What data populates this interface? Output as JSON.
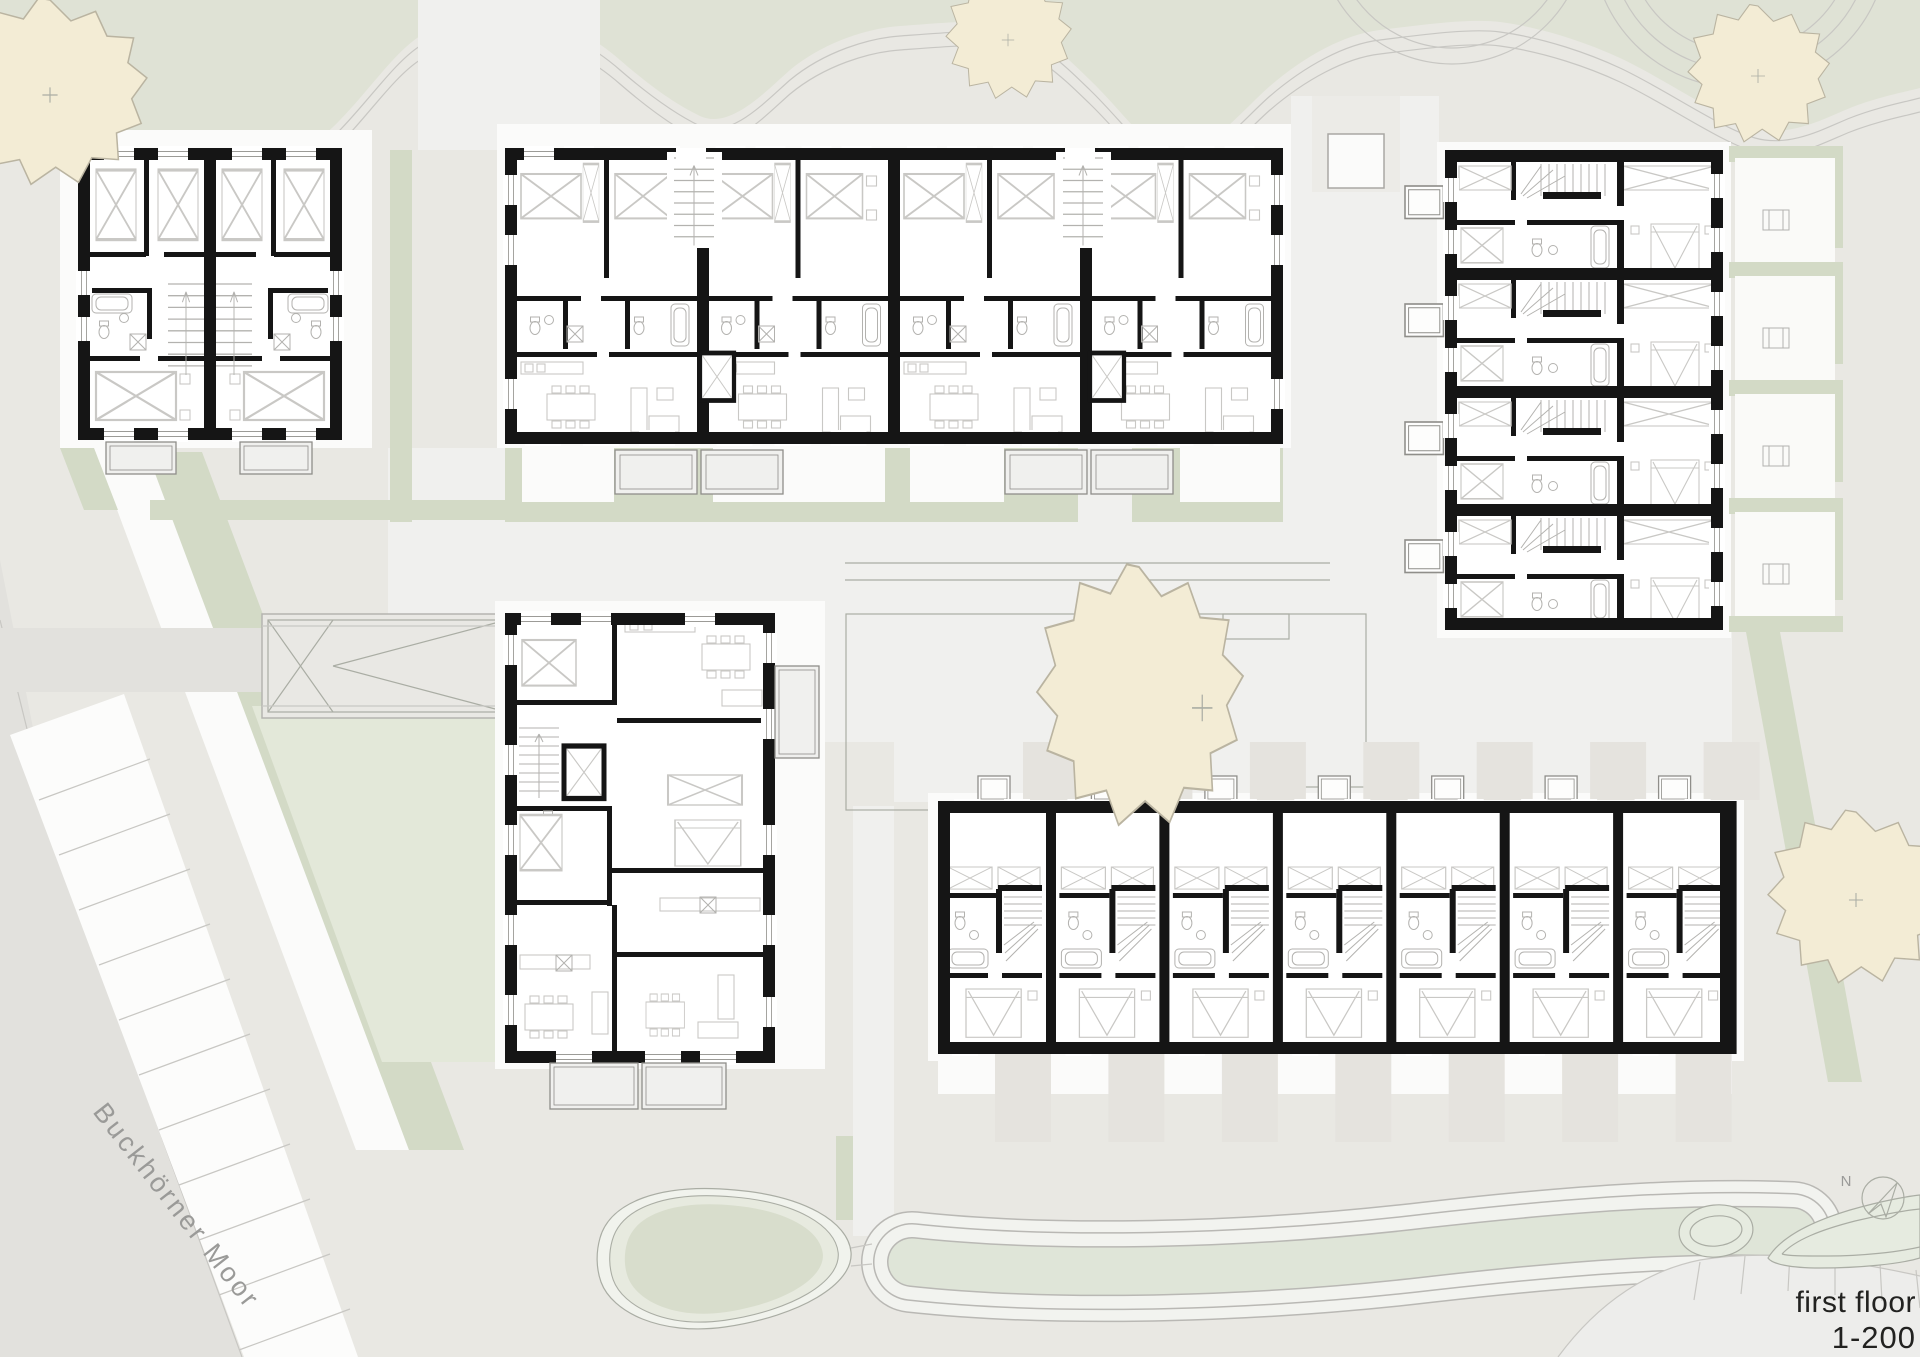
{
  "labels": {
    "floor": "first floor",
    "scale": "1-200",
    "street": "Buckhörner Moor",
    "north": "N"
  },
  "colors": {
    "base": "#e9e8e3",
    "band": "#dfe2d5",
    "hedge": "#d3dac6",
    "garden": "#e3e8d9",
    "plaza": "#f0f0ee",
    "pad": "#fbfbfa",
    "street": "#e2e1dd",
    "parking": "#fcfcfb",
    "graypad": "#e5e3de",
    "wall": "#151515",
    "furniture": "#c9c8c5",
    "fixture": "#b3b2af",
    "outline": "#aaada4",
    "edge": "#c8c7c3",
    "sill": "#9c9b97",
    "tree": "#f3ecd5",
    "treeline": "#bab4a1",
    "pondouter": "#f1f3ed",
    "pondmid": "#e7eadf",
    "pondcore": "#d8ddcc",
    "island": "#e6ebe0",
    "labelgray": "#9a9a98",
    "labelblack": "#222220"
  }
}
